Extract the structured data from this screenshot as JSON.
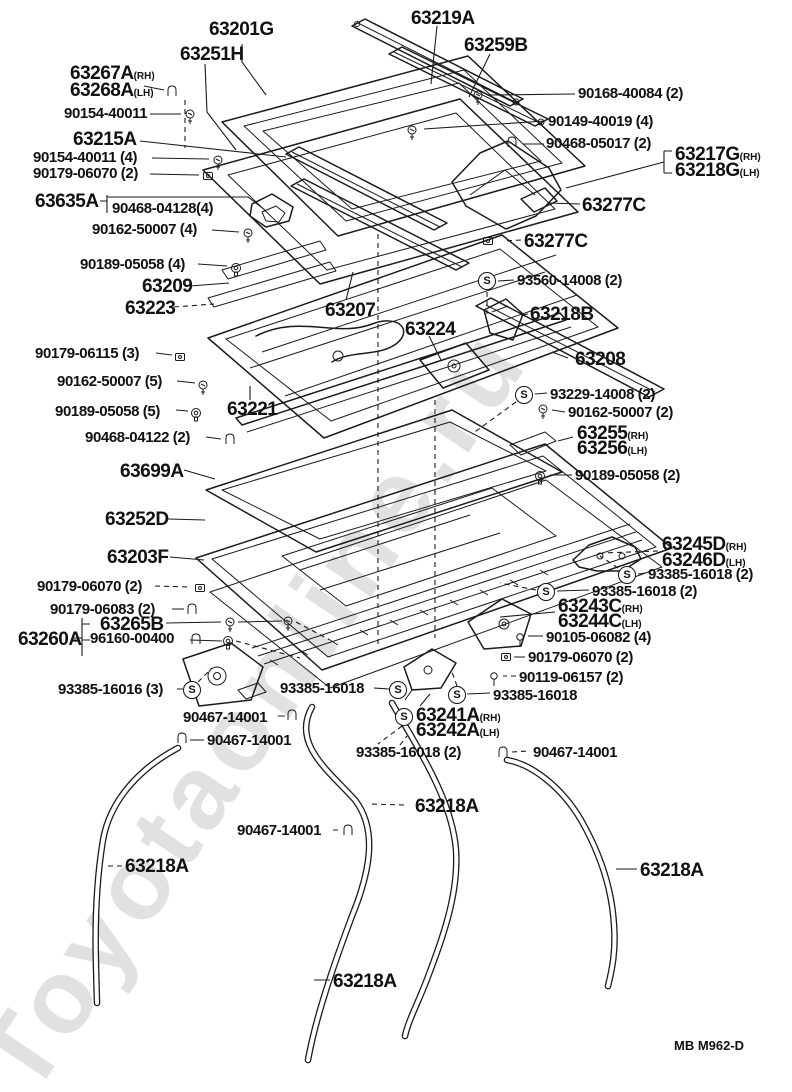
{
  "page": {
    "footer_code": "MB M962-D",
    "watermark": "Toyotaonline.ru",
    "line_color": "#1b1b1b",
    "background": "#ffffff"
  },
  "s_glyph": "S",
  "part_labels": [
    {
      "text": "63201G",
      "x": 209,
      "y": 20
    },
    {
      "text": "63219A",
      "x": 411,
      "y": 9
    },
    {
      "text": "63251H",
      "x": 180,
      "y": 45
    },
    {
      "text": "63259B",
      "x": 464,
      "y": 36
    },
    {
      "text": "63267A",
      "suffix": "(RH)",
      "x": 70,
      "y": 64
    },
    {
      "text": "63268A",
      "suffix": "(LH)",
      "x": 70,
      "y": 81
    },
    {
      "text": "63215A",
      "x": 73,
      "y": 130
    },
    {
      "text": "63635A",
      "x": 35,
      "y": 192
    },
    {
      "text": "63277C",
      "x": 582,
      "y": 196
    },
    {
      "text": "63277C",
      "x": 524,
      "y": 232
    },
    {
      "text": "63217G",
      "suffix": "(RH)",
      "x": 675,
      "y": 145
    },
    {
      "text": "63218G",
      "suffix": "(LH)",
      "x": 675,
      "y": 161
    },
    {
      "text": "63209",
      "x": 142,
      "y": 277
    },
    {
      "text": "63223",
      "x": 125,
      "y": 299
    },
    {
      "text": "63207",
      "x": 325,
      "y": 301
    },
    {
      "text": "63218B",
      "x": 530,
      "y": 305
    },
    {
      "text": "63224",
      "x": 405,
      "y": 320
    },
    {
      "text": "63208",
      "x": 575,
      "y": 350
    },
    {
      "text": "63221",
      "x": 227,
      "y": 400
    },
    {
      "text": "63255",
      "suffix": "(RH)",
      "x": 577,
      "y": 424
    },
    {
      "text": "63256",
      "suffix": "(LH)",
      "x": 577,
      "y": 439
    },
    {
      "text": "63699A",
      "x": 120,
      "y": 462
    },
    {
      "text": "63252D",
      "x": 105,
      "y": 510
    },
    {
      "text": "63203F",
      "x": 107,
      "y": 548
    },
    {
      "text": "63245D",
      "suffix": "(RH)",
      "x": 662,
      "y": 535
    },
    {
      "text": "63246D",
      "suffix": "(LH)",
      "x": 662,
      "y": 551
    },
    {
      "text": "63243C",
      "suffix": "(RH)",
      "x": 558,
      "y": 597
    },
    {
      "text": "63244C",
      "suffix": "(LH)",
      "x": 558,
      "y": 612
    },
    {
      "text": "63265B",
      "x": 100,
      "y": 615
    },
    {
      "text": "63260A",
      "x": 18,
      "y": 630
    },
    {
      "text": "63241A",
      "suffix": "(RH)",
      "x": 416,
      "y": 706
    },
    {
      "text": "63242A",
      "suffix": "(LH)",
      "x": 416,
      "y": 721
    },
    {
      "text": "63218A",
      "x": 415,
      "y": 797
    },
    {
      "text": "63218A",
      "x": 125,
      "y": 857
    },
    {
      "text": "63218A",
      "x": 640,
      "y": 861
    },
    {
      "text": "63218A",
      "x": 333,
      "y": 972
    }
  ],
  "fastener_labels": [
    {
      "text": "90168-40084 (2)",
      "x": 578,
      "y": 86
    },
    {
      "text": "90154-40011",
      "x": 64,
      "y": 106
    },
    {
      "text": "90149-40019 (4)",
      "x": 548,
      "y": 114
    },
    {
      "text": "90468-05017 (2)",
      "x": 546,
      "y": 136
    },
    {
      "text": "90154-40011 (4)",
      "x": 33,
      "y": 150
    },
    {
      "text": "90179-06070 (2)",
      "x": 33,
      "y": 166
    },
    {
      "text": "90468-04128(4)",
      "x": 112,
      "y": 201
    },
    {
      "text": "90162-50007 (4)",
      "x": 92,
      "y": 222
    },
    {
      "text": "90189-05058 (4)",
      "x": 80,
      "y": 257
    },
    {
      "text": "93560-14008 (2)",
      "x": 517,
      "y": 273
    },
    {
      "text": "90179-06115 (3)",
      "x": 35,
      "y": 346
    },
    {
      "text": "90162-50007 (5)",
      "x": 57,
      "y": 374
    },
    {
      "text": "93229-14008 (2)",
      "x": 550,
      "y": 387
    },
    {
      "text": "90189-05058 (5)",
      "x": 55,
      "y": 404
    },
    {
      "text": "90162-50007 (2)",
      "x": 568,
      "y": 405
    },
    {
      "text": "90468-04122 (2)",
      "x": 85,
      "y": 430
    },
    {
      "text": "90189-05058 (2)",
      "x": 575,
      "y": 468
    },
    {
      "text": "90179-06070 (2)",
      "x": 37,
      "y": 579
    },
    {
      "text": "93385-16018 (2)",
      "x": 648,
      "y": 567
    },
    {
      "text": "93385-16018 (2)",
      "x": 592,
      "y": 584
    },
    {
      "text": "90179-06083 (2)",
      "x": 50,
      "y": 602
    },
    {
      "text": "96160-00400",
      "x": 90,
      "y": 631
    },
    {
      "text": "90105-06082 (4)",
      "x": 546,
      "y": 630
    },
    {
      "text": "90179-06070 (2)",
      "x": 528,
      "y": 650
    },
    {
      "text": "90119-06157 (2)",
      "x": 519,
      "y": 670
    },
    {
      "text": "93385-16016 (3)",
      "x": 58,
      "y": 682
    },
    {
      "text": "93385-16018",
      "x": 280,
      "y": 681
    },
    {
      "text": "93385-16018",
      "x": 493,
      "y": 688
    },
    {
      "text": "90467-14001",
      "x": 183,
      "y": 710
    },
    {
      "text": "90467-14001",
      "x": 207,
      "y": 733
    },
    {
      "text": "93385-16018 (2)",
      "x": 356,
      "y": 745
    },
    {
      "text": "90467-14001",
      "x": 533,
      "y": 745
    },
    {
      "text": "90467-14001",
      "x": 237,
      "y": 823
    }
  ],
  "s_symbols": [
    {
      "x": 487,
      "y": 281
    },
    {
      "x": 524,
      "y": 395
    },
    {
      "x": 627,
      "y": 575
    },
    {
      "x": 546,
      "y": 592
    },
    {
      "x": 192,
      "y": 690
    },
    {
      "x": 398,
      "y": 690
    },
    {
      "x": 457,
      "y": 695
    },
    {
      "x": 404,
      "y": 717
    }
  ],
  "icons": [
    {
      "type": "clip",
      "x": 172,
      "y": 92
    },
    {
      "type": "screw",
      "x": 190,
      "y": 114
    },
    {
      "type": "screw",
      "x": 478,
      "y": 95
    },
    {
      "type": "screw",
      "x": 412,
      "y": 130
    },
    {
      "type": "clip",
      "x": 512,
      "y": 143
    },
    {
      "type": "screw",
      "x": 218,
      "y": 160
    },
    {
      "type": "nut",
      "x": 208,
      "y": 176
    },
    {
      "type": "screw",
      "x": 248,
      "y": 233
    },
    {
      "type": "grommet",
      "x": 236,
      "y": 268
    },
    {
      "type": "nut",
      "x": 488,
      "y": 241
    },
    {
      "type": "nut",
      "x": 180,
      "y": 357
    },
    {
      "type": "screw",
      "x": 203,
      "y": 385
    },
    {
      "type": "grommet",
      "x": 196,
      "y": 413
    },
    {
      "type": "clip",
      "x": 230,
      "y": 440
    },
    {
      "type": "screw",
      "x": 543,
      "y": 409
    },
    {
      "type": "grommet",
      "x": 540,
      "y": 476
    },
    {
      "type": "nut",
      "x": 200,
      "y": 588
    },
    {
      "type": "clip",
      "x": 192,
      "y": 610
    },
    {
      "type": "screw",
      "x": 230,
      "y": 622
    },
    {
      "type": "screw",
      "x": 288,
      "y": 621
    },
    {
      "type": "clip",
      "x": 196,
      "y": 640
    },
    {
      "type": "grommet",
      "x": 228,
      "y": 641
    },
    {
      "type": "bolt",
      "x": 520,
      "y": 637
    },
    {
      "type": "nut",
      "x": 506,
      "y": 657
    },
    {
      "type": "bolt",
      "x": 494,
      "y": 676
    },
    {
      "type": "clip",
      "x": 292,
      "y": 716
    },
    {
      "type": "clip",
      "x": 182,
      "y": 739
    },
    {
      "type": "clip",
      "x": 348,
      "y": 831
    },
    {
      "type": "clip",
      "x": 503,
      "y": 753
    }
  ]
}
